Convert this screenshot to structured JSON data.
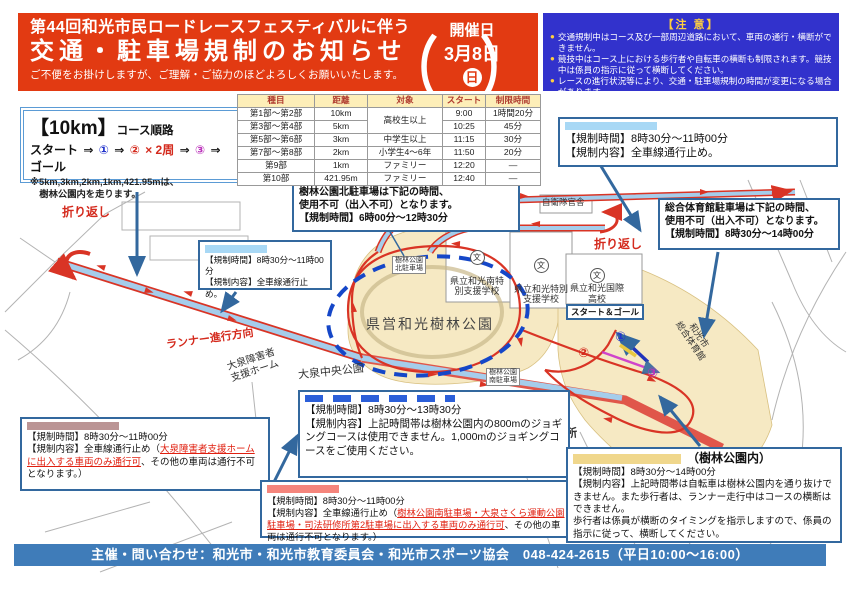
{
  "header": {
    "title_line1": "第44回和光市民ロードレースフェスティバルに伴う",
    "title_line2": "交通・駐車場規制のお知らせ",
    "subtitle": "ご不便をお掛けしますが、ご理解・ご協力のほどよろしくお願いいたします。",
    "date_label": "開催日",
    "date_value": "3月8日",
    "date_day": "日",
    "bracket_open": "（",
    "bracket_close": "）",
    "bg_color": "#e23a12"
  },
  "notice": {
    "heading": "【注 意】",
    "bullet_glyph": "●",
    "bullets": [
      "交通規制中はコース及び一部周辺道路において、車両の通行・横断ができません。",
      "競技中はコース上における歩行者や自転車の横断も制限されます。競技中は係員の指示に従って横断してください。",
      "レースの進行状況等により、交通・駐車場規制の時間が変更になる場合があります。"
    ],
    "bg_color": "#3232cc"
  },
  "course_box": {
    "title": "【10km】",
    "title_suffix": "コース順路",
    "route": {
      "start": "スタート",
      "arrow": "⇒",
      "n1": "①",
      "n2": "②",
      "loop": "× 2周",
      "n3": "③",
      "goal": "ゴール"
    },
    "note": "※5km,3km,2km,1km,421.95mは、\n　樹林公園内を走ります。"
  },
  "schedule": {
    "headers": [
      "種目",
      "距離",
      "対象",
      "スタート",
      "制限時間"
    ],
    "rows": [
      {
        "event": "第1部～第2部",
        "distance": "10km",
        "target": "高校生以上",
        "start": "9:00",
        "limit": "1時間20分"
      },
      {
        "event": "第3部～第4部",
        "distance": "5km",
        "start": "10:25",
        "limit": "45分"
      },
      {
        "event": "第5部～第6部",
        "distance": "3km",
        "target": "中学生以上",
        "start": "11:15",
        "limit": "30分"
      },
      {
        "event": "第7部～第8部",
        "distance": "2km",
        "target": "小学生4～6年",
        "start": "11:50",
        "limit": "20分"
      },
      {
        "event": "第9部",
        "distance": "1km",
        "target": "ファミリー",
        "start": "12:20",
        "limit": "―"
      },
      {
        "event": "第10部",
        "distance": "421.95m",
        "target": "ファミリー",
        "start": "12:40",
        "limit": "―"
      }
    ]
  },
  "callouts": {
    "a": {
      "time": "【規制時間】8時30分～11時00分",
      "content": "【規制内容】全車線通行止め。",
      "swatch_color": "#a8d8f5"
    },
    "b": {
      "line1": "樹林公園北駐車場は下記の時間、",
      "line2": "使用不可（出入不可）となります。",
      "time": "【規制時間】6時00分～12時30分"
    },
    "c": {
      "time": "【規制時間】8時30分～11時00分",
      "content": "【規制内容】全車線通行止め。",
      "swatch_color": "#a8d8f5"
    },
    "d": {
      "line1": "総合体育館駐車場は下記の時間、",
      "line2": "使用不可（出入不可）となります。",
      "time": "【規制時間】8時30分～14時00分"
    },
    "e": {
      "time": "【規制時間】8時30分～11時00分",
      "pre": "【規制内容】全車線通行止め（",
      "em": "大泉障害者支援ホームに出入する車両のみ通行可",
      "post": "、その他の車両は通行不可となります。）",
      "swatch_color": "#bb9595"
    },
    "f": {
      "time": "【規制時間】8時30分～13時30分",
      "content": "【規制内容】上記時間帯は樹林公園内の800mのジョギングコースは使用できません。1,000mのジョギングコースをご使用ください。",
      "swatch_color": "#2b5fd9"
    },
    "g": {
      "time": "【規制時間】8時30分～11時00分",
      "pre": "【規制内容】全車線通行止め（",
      "em": "樹林公園南駐車場・大泉さくら運動公園駐車場・司法研修所第2駐車場に出入する車両のみ通行可",
      "post": "、その他の車両は通行不可となります。）",
      "swatch_color": "#f5857c"
    },
    "h": {
      "title": "（樹林公園内）",
      "time": "【規制時間】8時30分～14時00分",
      "content1": "【規制内容】上記時間帯は自転車は樹林公園内を通り抜けできません。また歩行者は、ランナー走行中はコースの横断はできません。",
      "content2": "歩行者は係員が横断のタイミングを指示しますので、係員の指示に従って、横断してください。",
      "swatch_color": "#f0d78c"
    }
  },
  "map": {
    "labels": {
      "turnaround1": "折り返し",
      "turnaround2": "折り返し",
      "runner_direction": "ランナー進行方向",
      "oizumi_shien_home": "大泉障害者\n支援ホーム",
      "oizumi_chuo_park": "大泉中央公園",
      "jurin_park": "県営和光樹林公園",
      "north_parking": "樹林公園\n北駐車場",
      "south_parking": "樹林公園\n南駐車場",
      "school_minami": "県立和光南特\n別支援学校",
      "school_tokubetsu": "県立和光特別\n支援学校",
      "school_kokusai": "県立和光国際\n高校",
      "school_mark": "文",
      "jieitai": "自衛隊官舎",
      "gym": "和光市\n総合体育館",
      "start_goal": "スタート＆ゴール",
      "point1": "①",
      "point2": "②",
      "point3": "③",
      "shiho_kenshujo": "司法研修所",
      "oizumi_sakura": "大泉さくら\n運動公園"
    },
    "colors": {
      "park": "#f6e9c3",
      "road": "#a5cdeb",
      "course": "#d93425",
      "dashed_loop": "#1547c8",
      "leader": "#33689e"
    }
  },
  "footer": {
    "text": "主催・問い合わせ：和光市・和光市教育委員会・和光市スポーツ協会　048-424-2615（平日10:00～16:00）"
  }
}
